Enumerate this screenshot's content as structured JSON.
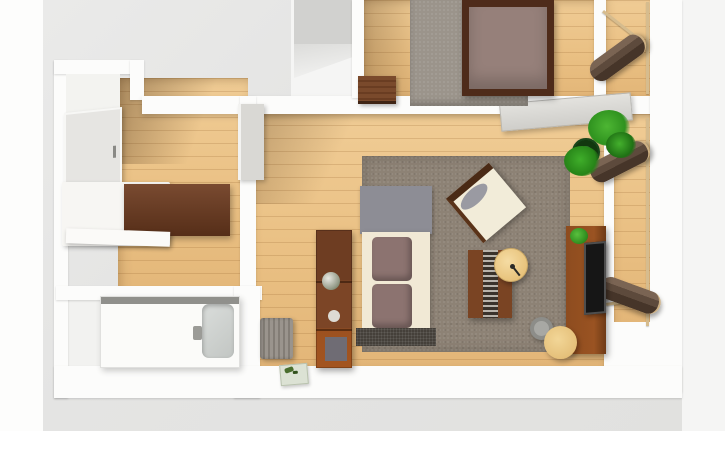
{
  "scene": {
    "title": "3D apartment floor plan - top-down render",
    "view": "top-down 3d",
    "visible_text": "none",
    "palette": {
      "ground": "#e4e4e3",
      "walls": "#fcfcfb",
      "wood_floor": "#e9bf82",
      "bedroom_rug": "#9b948b",
      "living_rug": "#8d8275",
      "bed_frame": "#4e2b1a",
      "bed_blanket": "#96807a",
      "single_bed_duvet": "#6e3b1f",
      "sofa_cream": "#f1e9d5",
      "sofa_cushion": "#8c7370",
      "sofa_back": "#8d8d95",
      "wood_furniture": "#7a4423",
      "tv_stand": "#8d4c1f",
      "tv_screen": "#161616",
      "plant_green": "#2f921f",
      "lounger_brown": "#5d4a3c",
      "railing_beige": "#d6bc8e",
      "accent_tan": "#e7c179"
    }
  },
  "rooms": [
    {
      "id": "bedroom",
      "floor": "wood",
      "items": [
        "double-bed",
        "area-rug",
        "wicker-dresser"
      ]
    },
    {
      "id": "bedroom-balcony",
      "floor": "wood",
      "items": [
        "lounge-chair",
        "railing"
      ]
    },
    {
      "id": "living-room",
      "floor": "wood",
      "items": [
        "sofa-bed",
        "area-rug",
        "armchair",
        "coffee-table",
        "round-side-table",
        "shelving-unit",
        "tv-stand",
        "tv",
        "stool",
        "waste-bin",
        "potted-plant",
        "sliding-door"
      ]
    },
    {
      "id": "living-balcony",
      "floor": "wood",
      "items": [
        "lounge-chair",
        "lounge-chair",
        "railing"
      ]
    },
    {
      "id": "hall-room",
      "floor": "wood",
      "items": [
        "single-bed",
        "entrance-door",
        "interior-door"
      ]
    },
    {
      "id": "closet",
      "floor": "white",
      "items": [
        "cabinet"
      ]
    },
    {
      "id": "bathroom",
      "floor": "white",
      "items": [
        "bathtub",
        "laundry-hamper",
        "bath-mat"
      ]
    }
  ],
  "labels": {
    "double_bed": "Double bed",
    "bedroom_rug": "Bedroom area rug",
    "dresser": "Wicker dresser",
    "lounge_top": "Lounge chair (bedroom balcony)",
    "lounge_mid": "Lounge chair (living balcony)",
    "lounge_bottom": "Lounge chair (living balcony)",
    "railing": "Balcony railing",
    "sliding_door": "Sliding door",
    "plant": "Potted plant",
    "sofa": "Sofa bed",
    "living_rug": "Living room rug",
    "armchair": "Armchair",
    "coffee_table": "Coffee table",
    "side_table": "Round side table",
    "stool": "Round stool",
    "bin": "Waste bin",
    "bookshelf": "Shelving unit",
    "tv_stand": "TV stand",
    "tv": "Television",
    "tv_plant": "Plant on TV stand",
    "single_bed": "Single bed",
    "entry_door": "Entrance door",
    "interior_door": "Interior door",
    "closet_cabinet": "Closet cabinet",
    "bathtub": "Bathtub",
    "hamper": "Laundry hamper",
    "bath_mat": "Bath mat"
  }
}
